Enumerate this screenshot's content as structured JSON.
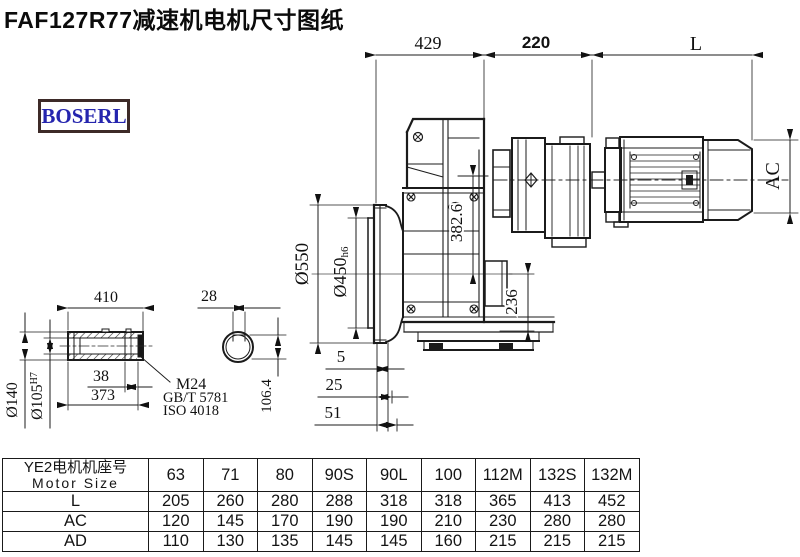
{
  "title": "FAF127R77减速机电机尺寸图纸",
  "brand": {
    "logo_text": "BOSERL"
  },
  "drawing": {
    "top_dims": {
      "d429": "429",
      "d220": "220",
      "dL": "L"
    },
    "side_dims": {
      "ac": "AC",
      "dia550": "Ø550",
      "dia450": "Ø450",
      "dia450_suffix": "h6",
      "d3826": "382.6",
      "d236": "236"
    },
    "bottom_dims": {
      "d5": "5",
      "d25": "25",
      "d51": "51"
    },
    "shaft": {
      "d410": "410",
      "d28": "28",
      "d38": "38",
      "d373": "373",
      "dia140": "Ø140",
      "dia105": "Ø105",
      "dia105_suffix": "H7",
      "thread": "M24",
      "std_gb": "GB/T 5781",
      "std_iso": "ISO 4018",
      "d1064": "106.4"
    }
  },
  "table": {
    "header": {
      "cn": "YE2电机机座号",
      "en": "Motor Size"
    },
    "columns": [
      "63",
      "71",
      "80",
      "90S",
      "90L",
      "100",
      "112M",
      "132S",
      "132M"
    ],
    "rows": [
      {
        "label": "L",
        "values": [
          "205",
          "260",
          "280",
          "288",
          "318",
          "318",
          "365",
          "413",
          "452"
        ]
      },
      {
        "label": "AC",
        "values": [
          "120",
          "145",
          "170",
          "190",
          "190",
          "210",
          "230",
          "280",
          "280"
        ]
      },
      {
        "label": "AD",
        "values": [
          "110",
          "130",
          "135",
          "145",
          "145",
          "160",
          "215",
          "215",
          "215"
        ]
      }
    ]
  }
}
